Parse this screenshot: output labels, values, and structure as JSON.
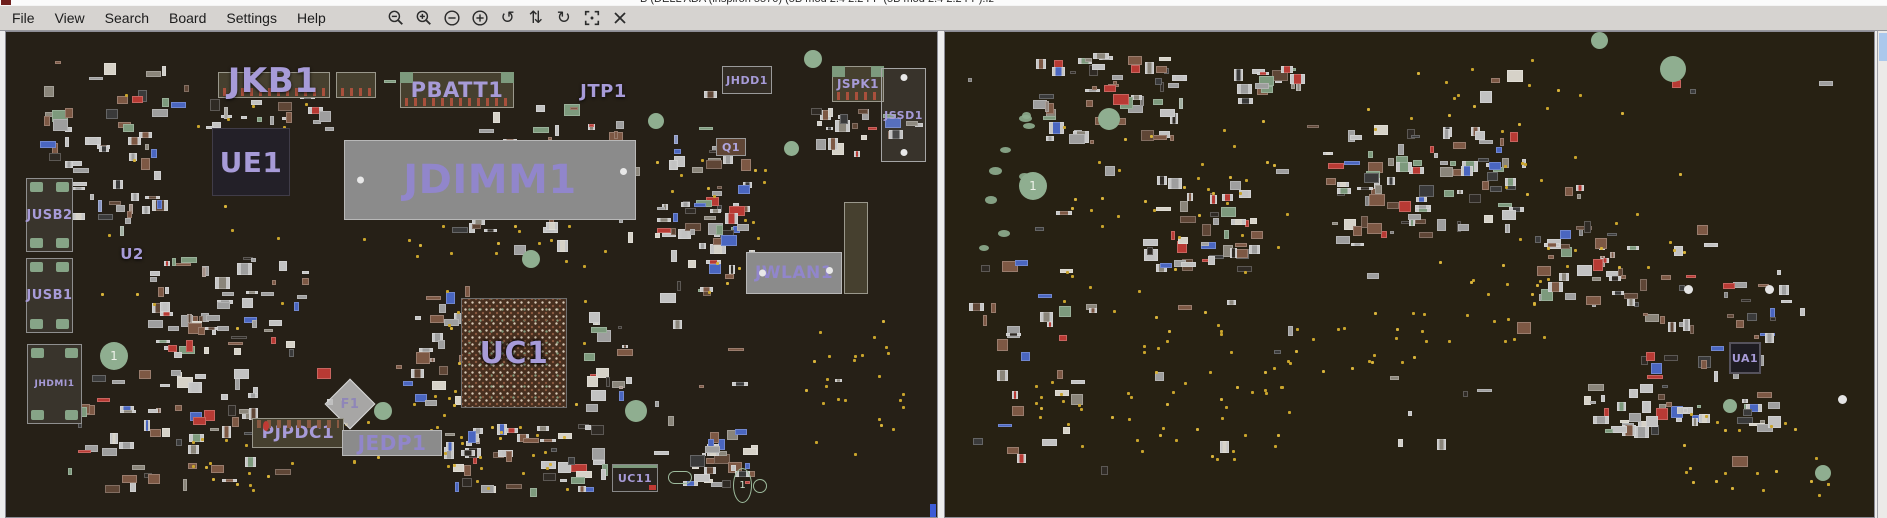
{
  "colors": {
    "label": "#a79bd8",
    "board_bg_left": "#262017",
    "board_bg_right": "#272113",
    "via_dot": "#c9a42c",
    "hole_green": "#8fae90",
    "menubar_bg": "#d6d3d0",
    "selection_blue": "#abc8ec"
  },
  "window": {
    "title": "B (DELL ADA (inspiron 5570) (5B mod 2.4 2.2 FP (5B mod 2.4 2.2 FP).fz"
  },
  "menu_bar": {
    "items": [
      "File",
      "View",
      "Search",
      "Board",
      "Settings",
      "Help"
    ]
  },
  "toolbar": {
    "icons": [
      {
        "name": "zoom-out-icon",
        "type": "svg"
      },
      {
        "name": "zoom-in-icon",
        "type": "svg"
      },
      {
        "name": "zoom-decrease-icon",
        "type": "svg"
      },
      {
        "name": "zoom-increase-icon",
        "type": "svg"
      },
      {
        "name": "rotate-ccw-icon",
        "type": "glyph",
        "glyph": "↺"
      },
      {
        "name": "flip-vertical-icon",
        "type": "glyph",
        "glyph": "⇅"
      },
      {
        "name": "rotate-cw-icon",
        "type": "glyph",
        "glyph": "↻"
      },
      {
        "name": "center-focus-icon",
        "type": "svg"
      },
      {
        "name": "close-icon",
        "type": "svg"
      }
    ]
  },
  "boards": {
    "left": {
      "components": [
        {
          "label": "",
          "type": "connector",
          "x": 212,
          "y": 40,
          "w": 112,
          "h": 26
        },
        {
          "label": "",
          "type": "connector",
          "x": 330,
          "y": 40,
          "w": 40,
          "h": 26
        },
        {
          "label": "JKB1",
          "type": "text",
          "x": 192,
          "y": 28,
          "w": 150,
          "h": 42,
          "size": 34
        },
        {
          "label": "PBATT1",
          "type": "connector-green",
          "x": 394,
          "y": 40,
          "w": 114,
          "h": 36,
          "size": 21
        },
        {
          "label": "JTP1",
          "type": "text",
          "x": 560,
          "y": 48,
          "w": 75,
          "h": 22,
          "size": 18
        },
        {
          "label": "JHDD1",
          "type": "box",
          "x": 716,
          "y": 34,
          "w": 50,
          "h": 28,
          "size": 11
        },
        {
          "label": "JSPK1",
          "type": "connector-green",
          "x": 826,
          "y": 34,
          "w": 52,
          "h": 36,
          "size": 12
        },
        {
          "label": "JSSD1",
          "type": "box-dots",
          "x": 875,
          "y": 36,
          "w": 45,
          "h": 94,
          "size": 11
        },
        {
          "label": "UE1",
          "type": "chip-dark",
          "x": 206,
          "y": 96,
          "w": 78,
          "h": 68,
          "size": 28
        },
        {
          "label": "JDIMM1",
          "type": "slot-dots",
          "x": 338,
          "y": 108,
          "w": 292,
          "h": 80,
          "size": 40
        },
        {
          "label": "U2",
          "type": "text",
          "x": 106,
          "y": 212,
          "w": 40,
          "h": 20,
          "size": 15
        },
        {
          "label": "",
          "type": "connector",
          "x": 838,
          "y": 170,
          "w": 24,
          "h": 92
        },
        {
          "label": "JWLAN1",
          "type": "slot-dots",
          "x": 740,
          "y": 220,
          "w": 96,
          "h": 42,
          "size": 17
        },
        {
          "label": "JUSB2",
          "type": "port",
          "x": 20,
          "y": 146,
          "w": 47,
          "h": 74,
          "size": 13
        },
        {
          "label": "JUSB1",
          "type": "port",
          "x": 20,
          "y": 226,
          "w": 47,
          "h": 75,
          "size": 13
        },
        {
          "label": "JHDMI1",
          "type": "port",
          "x": 21,
          "y": 312,
          "w": 55,
          "h": 80,
          "size": 9
        },
        {
          "label": "Q1",
          "type": "smallchip",
          "x": 710,
          "y": 106,
          "w": 30,
          "h": 18,
          "size": 11
        },
        {
          "label": "UC1",
          "type": "bga",
          "x": 455,
          "y": 266,
          "w": 106,
          "h": 110,
          "size": 30
        },
        {
          "label": "F1",
          "type": "diamond",
          "x": 326,
          "y": 354,
          "w": 36,
          "h": 36,
          "size": 13
        },
        {
          "label": "PJPDC1",
          "type": "connector-pins",
          "x": 246,
          "y": 386,
          "w": 92,
          "h": 30,
          "size": 17
        },
        {
          "label": "JEDP1",
          "type": "slot",
          "x": 336,
          "y": 398,
          "w": 100,
          "h": 26,
          "size": 20
        },
        {
          "label": "UC11",
          "type": "smallchip2",
          "x": 606,
          "y": 432,
          "w": 46,
          "h": 28,
          "size": 11
        }
      ],
      "markers": [
        {
          "kind": "hole",
          "text": "1",
          "x": 94,
          "y": 310,
          "d": 28
        },
        {
          "kind": "hole",
          "x": 516,
          "y": 218,
          "d": 18
        },
        {
          "kind": "hole",
          "x": 642,
          "y": 81,
          "d": 16
        },
        {
          "kind": "hole",
          "x": 778,
          "y": 109,
          "d": 15
        },
        {
          "kind": "hole",
          "x": 798,
          "y": 18,
          "d": 18
        },
        {
          "kind": "hole",
          "x": 368,
          "y": 370,
          "d": 18
        },
        {
          "kind": "hole",
          "x": 619,
          "y": 368,
          "d": 22
        },
        {
          "kind": "stadium",
          "x": 662,
          "y": 439,
          "w": 24,
          "h": 13
        },
        {
          "kind": "outline-ellipse",
          "text": "1",
          "x": 727,
          "y": 436,
          "w": 19,
          "h": 35
        },
        {
          "kind": "outline-circle",
          "x": 747,
          "y": 447,
          "d": 14
        }
      ]
    },
    "right": {
      "components": [
        {
          "label": "UA1",
          "type": "chip-dark2",
          "x": 784,
          "y": 310,
          "w": 32,
          "h": 32,
          "size": 11
        }
      ],
      "markers": [
        {
          "kind": "hole",
          "text": "1",
          "x": 74,
          "y": 140,
          "d": 28
        },
        {
          "kind": "hole",
          "x": 153,
          "y": 76,
          "d": 22
        },
        {
          "kind": "hole",
          "x": 715,
          "y": 24,
          "d": 26
        },
        {
          "kind": "hole",
          "x": 646,
          "y": 0,
          "d": 17
        },
        {
          "kind": "hole",
          "x": 778,
          "y": 367,
          "d": 14
        },
        {
          "kind": "hole",
          "x": 870,
          "y": 433,
          "d": 16
        },
        {
          "kind": "white-dot",
          "x": 739,
          "y": 253,
          "d": 9
        },
        {
          "kind": "white-dot",
          "x": 820,
          "y": 253,
          "d": 9
        },
        {
          "kind": "white-dot",
          "x": 893,
          "y": 363,
          "d": 9
        }
      ]
    }
  }
}
